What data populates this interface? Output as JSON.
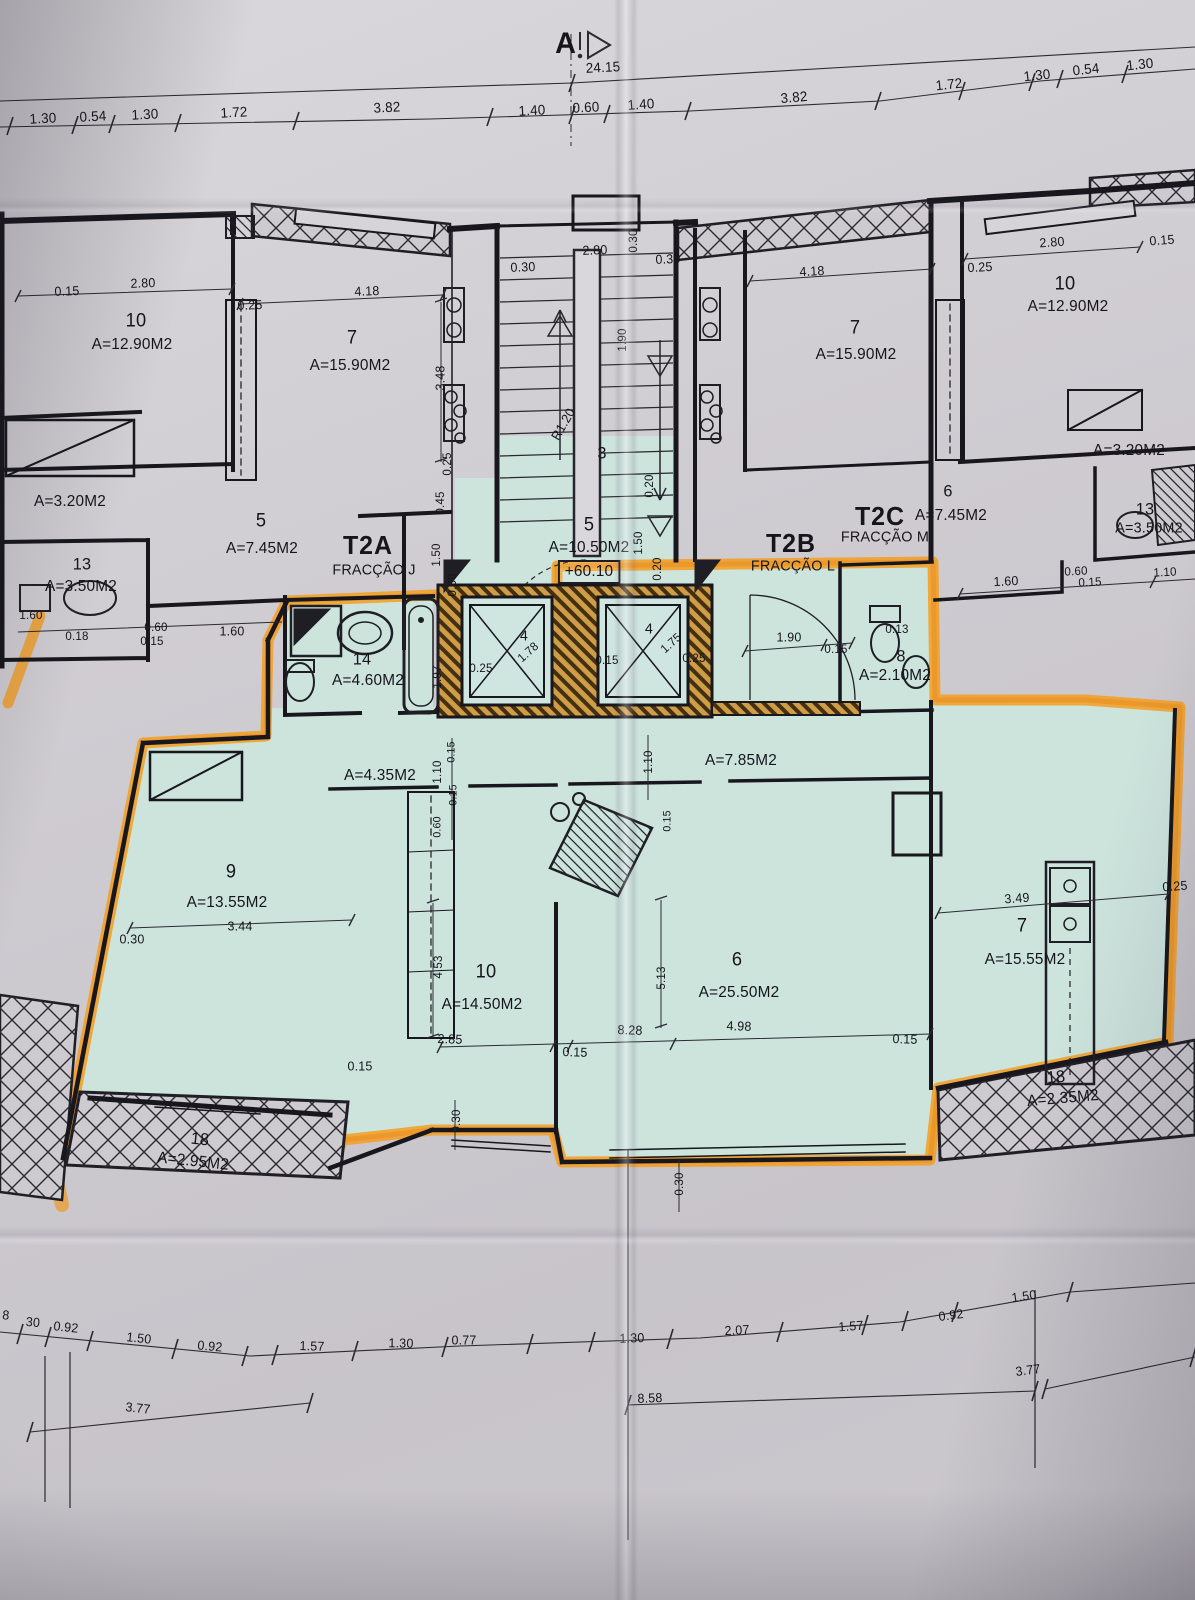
{
  "drawing": {
    "section_marker": "A",
    "overall_dimension": "24.15",
    "elevation_label": "+60.10",
    "fractions": [
      {
        "code": "T2A",
        "name": "FRACÇÃO J"
      },
      {
        "code": "T2B",
        "name": "FRACÇÃO L"
      },
      {
        "code": "T2C",
        "name": "FRACÇÃO M"
      }
    ],
    "colors": {
      "paper": "#cfccd2",
      "highlight_teal": "#cde4dd",
      "highlighter_orange": "#f49d20",
      "ink": "#1e1e24"
    }
  },
  "labels": [
    {
      "t": "A",
      "x": 566,
      "y": 44,
      "s": 30,
      "n": "section-marker-label",
      "b": 1
    },
    {
      "t": "24.15",
      "x": 603,
      "y": 67,
      "s": 14,
      "r": -3,
      "n": "dimension-label"
    },
    {
      "t": "1.30",
      "x": 43,
      "y": 118,
      "s": 14,
      "r": -3,
      "n": "dimension-label"
    },
    {
      "t": "0.54",
      "x": 93,
      "y": 116,
      "s": 14,
      "r": -3,
      "n": "dimension-label"
    },
    {
      "t": "1.30",
      "x": 145,
      "y": 114,
      "s": 14,
      "r": -3,
      "n": "dimension-label"
    },
    {
      "t": "1.72",
      "x": 234,
      "y": 112,
      "s": 14,
      "r": -3,
      "n": "dimension-label"
    },
    {
      "t": "3.82",
      "x": 387,
      "y": 107,
      "s": 14,
      "r": -3,
      "n": "dimension-label"
    },
    {
      "t": "1.40",
      "x": 532,
      "y": 110,
      "s": 14,
      "r": -3,
      "n": "dimension-label"
    },
    {
      "t": "0.60",
      "x": 586,
      "y": 107,
      "s": 14,
      "r": -3,
      "n": "dimension-label"
    },
    {
      "t": "1.40",
      "x": 641,
      "y": 104,
      "s": 14,
      "r": -4,
      "n": "dimension-label"
    },
    {
      "t": "3.82",
      "x": 794,
      "y": 97,
      "s": 14,
      "r": -5,
      "n": "dimension-label"
    },
    {
      "t": "1.72",
      "x": 949,
      "y": 84,
      "s": 14,
      "r": -6,
      "n": "dimension-label"
    },
    {
      "t": "1.30",
      "x": 1037,
      "y": 75,
      "s": 14,
      "r": -6,
      "n": "dimension-label"
    },
    {
      "t": "0.54",
      "x": 1086,
      "y": 69,
      "s": 14,
      "r": -6,
      "n": "dimension-label"
    },
    {
      "t": "1.30",
      "x": 1140,
      "y": 64,
      "s": 14,
      "r": -6,
      "n": "dimension-label"
    },
    {
      "t": "0.15",
      "x": 67,
      "y": 291,
      "s": 13,
      "r": -2,
      "n": "dimension-label"
    },
    {
      "t": "2.80",
      "x": 143,
      "y": 283,
      "s": 13,
      "r": -2,
      "n": "dimension-label"
    },
    {
      "t": "0.25",
      "x": 250,
      "y": 305,
      "s": 13,
      "r": -2,
      "n": "dimension-label"
    },
    {
      "t": "4.18",
      "x": 367,
      "y": 291,
      "s": 13,
      "r": -2,
      "n": "dimension-label"
    },
    {
      "t": "10",
      "x": 136,
      "y": 321,
      "s": 19,
      "n": "room-number-label"
    },
    {
      "t": "A=12.90M2",
      "x": 132,
      "y": 345,
      "s": 16,
      "n": "room-area-label"
    },
    {
      "t": "7",
      "x": 352,
      "y": 338,
      "s": 19,
      "n": "room-number-label"
    },
    {
      "t": "A=15.90M2",
      "x": 350,
      "y": 366,
      "s": 16,
      "n": "room-area-label"
    },
    {
      "t": "3.48",
      "x": 440,
      "y": 378,
      "s": 13,
      "r": -90,
      "n": "dimension-label"
    },
    {
      "t": "A=3.20M2",
      "x": 70,
      "y": 502,
      "s": 16,
      "n": "room-area-label"
    },
    {
      "t": "5",
      "x": 261,
      "y": 521,
      "s": 19,
      "n": "room-number-label"
    },
    {
      "t": "A=7.45M2",
      "x": 262,
      "y": 549,
      "s": 16,
      "n": "room-area-label"
    },
    {
      "t": "13",
      "x": 82,
      "y": 564,
      "s": 17,
      "n": "room-number-label"
    },
    {
      "t": "A=3.50M2",
      "x": 81,
      "y": 587,
      "s": 16,
      "n": "room-area-label"
    },
    {
      "t": "1.60",
      "x": 31,
      "y": 615,
      "s": 12,
      "n": "dimension-label"
    },
    {
      "t": "0.18",
      "x": 77,
      "y": 636,
      "s": 12,
      "n": "dimension-label"
    },
    {
      "t": "0.60",
      "x": 156,
      "y": 627,
      "s": 12,
      "n": "dimension-label"
    },
    {
      "t": "0.15",
      "x": 152,
      "y": 641,
      "s": 12,
      "n": "dimension-label"
    },
    {
      "t": "1.60",
      "x": 232,
      "y": 631,
      "s": 13,
      "n": "dimension-label"
    },
    {
      "t": "T2A",
      "x": 368,
      "y": 545,
      "s": 26,
      "b": 1,
      "n": "unit-code-label"
    },
    {
      "t": "FRACÇÃO J",
      "x": 374,
      "y": 570,
      "s": 15,
      "n": "fraction-name-label"
    },
    {
      "t": "0.25",
      "x": 447,
      "y": 464,
      "s": 12,
      "r": -90,
      "n": "dimension-label"
    },
    {
      "t": "0.45",
      "x": 440,
      "y": 503,
      "s": 12,
      "r": -90,
      "n": "dimension-label"
    },
    {
      "t": "1.50",
      "x": 436,
      "y": 555,
      "s": 12,
      "r": -90,
      "n": "dimension-label"
    },
    {
      "t": "0.30",
      "x": 452,
      "y": 585,
      "s": 12,
      "r": -90,
      "n": "dimension-label"
    },
    {
      "t": "2.80",
      "x": 595,
      "y": 250,
      "s": 13,
      "r": -2,
      "n": "dimension-label"
    },
    {
      "t": "0.30",
      "x": 633,
      "y": 241,
      "s": 12,
      "r": -90,
      "n": "dimension-label"
    },
    {
      "t": "0.30",
      "x": 523,
      "y": 267,
      "s": 13,
      "r": -2,
      "n": "dimension-label"
    },
    {
      "t": "0.30",
      "x": 668,
      "y": 259,
      "s": 13,
      "r": -2,
      "n": "dimension-label"
    },
    {
      "t": "1.90",
      "x": 622,
      "y": 340,
      "s": 12,
      "r": -90,
      "n": "dimension-label"
    },
    {
      "t": "R1.20",
      "x": 563,
      "y": 424,
      "s": 13,
      "r": -60,
      "n": "dimension-label"
    },
    {
      "t": "3",
      "x": 602,
      "y": 453,
      "s": 17,
      "n": "room-number-label"
    },
    {
      "t": "5",
      "x": 589,
      "y": 525,
      "s": 19,
      "n": "room-number-label"
    },
    {
      "t": "A=10.50M2",
      "x": 589,
      "y": 548,
      "s": 16,
      "n": "room-area-label"
    },
    {
      "t": "+60.10",
      "x": 589,
      "y": 572,
      "s": 16,
      "box": 1,
      "n": "elevation-label"
    },
    {
      "t": "0.20",
      "x": 649,
      "y": 486,
      "s": 12,
      "r": -90,
      "n": "dimension-label"
    },
    {
      "t": "1.50",
      "x": 638,
      "y": 543,
      "s": 12,
      "r": -90,
      "n": "dimension-label"
    },
    {
      "t": "0.20",
      "x": 657,
      "y": 569,
      "s": 12,
      "r": -90,
      "n": "dimension-label"
    },
    {
      "t": "2.80",
      "x": 1052,
      "y": 242,
      "s": 13,
      "r": -4,
      "n": "dimension-label"
    },
    {
      "t": "0.15",
      "x": 1162,
      "y": 240,
      "s": 13,
      "r": -4,
      "n": "dimension-label"
    },
    {
      "t": "0.25",
      "x": 980,
      "y": 267,
      "s": 13,
      "r": -3,
      "n": "dimension-label"
    },
    {
      "t": "4.18",
      "x": 812,
      "y": 271,
      "s": 13,
      "r": -3,
      "n": "dimension-label"
    },
    {
      "t": "10",
      "x": 1065,
      "y": 284,
      "s": 19,
      "n": "room-number-label"
    },
    {
      "t": "A=12.90M2",
      "x": 1068,
      "y": 307,
      "s": 16,
      "n": "room-area-label"
    },
    {
      "t": "7",
      "x": 855,
      "y": 328,
      "s": 19,
      "n": "room-number-label"
    },
    {
      "t": "A=15.90M2",
      "x": 856,
      "y": 355,
      "s": 16,
      "n": "room-area-label"
    },
    {
      "t": "A=3.20M2",
      "x": 1129,
      "y": 451,
      "s": 16,
      "n": "room-area-label"
    },
    {
      "t": "6",
      "x": 948,
      "y": 491,
      "s": 17,
      "n": "room-number-label"
    },
    {
      "t": "A=7.45M2",
      "x": 951,
      "y": 516,
      "s": 16,
      "n": "room-area-label"
    },
    {
      "t": "13",
      "x": 1145,
      "y": 509,
      "s": 17,
      "n": "room-number-label"
    },
    {
      "t": "A=3.50M2",
      "x": 1149,
      "y": 528,
      "s": 15,
      "n": "room-area-label"
    },
    {
      "t": "T2C",
      "x": 880,
      "y": 516,
      "s": 26,
      "b": 1,
      "n": "unit-code-label"
    },
    {
      "t": "FRACÇÃO M",
      "x": 885,
      "y": 537,
      "s": 15,
      "n": "fraction-name-label"
    },
    {
      "t": "T2B",
      "x": 791,
      "y": 543,
      "s": 26,
      "b": 1,
      "n": "unit-code-label"
    },
    {
      "t": "FRACÇÃO L",
      "x": 793,
      "y": 566,
      "s": 15,
      "n": "fraction-name-label"
    },
    {
      "t": "1.60",
      "x": 1006,
      "y": 581,
      "s": 13,
      "r": -3,
      "n": "dimension-label"
    },
    {
      "t": "0.60",
      "x": 1076,
      "y": 571,
      "s": 12,
      "r": -3,
      "n": "dimension-label"
    },
    {
      "t": "0.15",
      "x": 1090,
      "y": 582,
      "s": 12,
      "r": -3,
      "n": "dimension-label"
    },
    {
      "t": "1.10",
      "x": 1165,
      "y": 572,
      "s": 12,
      "r": -3,
      "n": "dimension-label"
    },
    {
      "t": "14",
      "x": 362,
      "y": 659,
      "s": 17,
      "n": "room-number-label"
    },
    {
      "t": "A=4.60M2",
      "x": 368,
      "y": 681,
      "s": 16,
      "n": "room-area-label"
    },
    {
      "t": "1.97",
      "x": 437,
      "y": 677,
      "s": 12,
      "r": -90,
      "n": "dimension-label"
    },
    {
      "t": "0.25",
      "x": 481,
      "y": 668,
      "s": 12,
      "n": "dimension-label"
    },
    {
      "t": "4",
      "x": 524,
      "y": 636,
      "s": 15,
      "n": "room-number-label"
    },
    {
      "t": "1.78",
      "x": 528,
      "y": 652,
      "s": 12,
      "r": -42,
      "n": "dimension-label"
    },
    {
      "t": "4",
      "x": 649,
      "y": 629,
      "s": 15,
      "n": "room-number-label"
    },
    {
      "t": "1.75",
      "x": 671,
      "y": 643,
      "s": 12,
      "r": -42,
      "n": "dimension-label"
    },
    {
      "t": "0.15",
      "x": 607,
      "y": 660,
      "s": 12,
      "n": "dimension-label"
    },
    {
      "t": "0.25",
      "x": 694,
      "y": 658,
      "s": 12,
      "n": "dimension-label"
    },
    {
      "t": "1.90",
      "x": 789,
      "y": 637,
      "s": 13,
      "n": "dimension-label"
    },
    {
      "t": "0.15",
      "x": 836,
      "y": 649,
      "s": 12,
      "n": "dimension-label"
    },
    {
      "t": "0.13",
      "x": 897,
      "y": 629,
      "s": 12,
      "n": "dimension-label"
    },
    {
      "t": "8",
      "x": 901,
      "y": 656,
      "s": 17,
      "n": "room-number-label"
    },
    {
      "t": "A=2.10M2",
      "x": 895,
      "y": 676,
      "s": 16,
      "n": "room-area-label"
    },
    {
      "t": "A=4.35M2",
      "x": 380,
      "y": 776,
      "s": 16,
      "n": "room-area-label"
    },
    {
      "t": "1.10",
      "x": 437,
      "y": 772,
      "s": 12,
      "r": -90,
      "n": "dimension-label"
    },
    {
      "t": "0.15",
      "x": 452,
      "y": 752,
      "s": 11,
      "r": -90,
      "n": "dimension-label"
    },
    {
      "t": "0.15",
      "x": 454,
      "y": 795,
      "s": 11,
      "r": -90,
      "n": "dimension-label"
    },
    {
      "t": "0.60",
      "x": 438,
      "y": 827,
      "s": 11,
      "r": -90,
      "n": "dimension-label"
    },
    {
      "t": "1.10",
      "x": 648,
      "y": 762,
      "s": 12,
      "r": -90,
      "n": "dimension-label"
    },
    {
      "t": "A=7.85M2",
      "x": 741,
      "y": 761,
      "s": 16,
      "n": "room-area-label"
    },
    {
      "t": "0.15",
      "x": 668,
      "y": 821,
      "s": 11,
      "r": -90,
      "n": "dimension-label"
    },
    {
      "t": "9",
      "x": 231,
      "y": 872,
      "s": 19,
      "n": "room-number-label"
    },
    {
      "t": "A=13.55M2",
      "x": 227,
      "y": 903,
      "s": 16,
      "n": "room-area-label"
    },
    {
      "t": "3.44",
      "x": 240,
      "y": 926,
      "s": 13,
      "n": "dimension-label"
    },
    {
      "t": "0.30",
      "x": 132,
      "y": 939,
      "s": 13,
      "n": "dimension-label"
    },
    {
      "t": "4.53",
      "x": 438,
      "y": 967,
      "s": 12,
      "r": -90,
      "n": "dimension-label"
    },
    {
      "t": "10",
      "x": 486,
      "y": 972,
      "s": 19,
      "n": "room-number-label"
    },
    {
      "t": "A=14.50M2",
      "x": 482,
      "y": 1005,
      "s": 16,
      "n": "room-area-label"
    },
    {
      "t": "2.85",
      "x": 450,
      "y": 1039,
      "s": 13,
      "r": 2,
      "n": "dimension-label"
    },
    {
      "t": "0.15",
      "x": 575,
      "y": 1052,
      "s": 13,
      "r": 2,
      "n": "dimension-label"
    },
    {
      "t": "5.13",
      "x": 661,
      "y": 978,
      "s": 12,
      "r": -90,
      "n": "dimension-label"
    },
    {
      "t": "6",
      "x": 737,
      "y": 960,
      "s": 19,
      "n": "room-number-label"
    },
    {
      "t": "A=25.50M2",
      "x": 739,
      "y": 993,
      "s": 16,
      "n": "room-area-label"
    },
    {
      "t": "8.28",
      "x": 630,
      "y": 1030,
      "s": 13,
      "r": 2,
      "n": "dimension-label"
    },
    {
      "t": "4.98",
      "x": 739,
      "y": 1026,
      "s": 13,
      "r": 2,
      "n": "dimension-label"
    },
    {
      "t": "0.15",
      "x": 905,
      "y": 1039,
      "s": 13,
      "r": 2,
      "n": "dimension-label"
    },
    {
      "t": "3.49",
      "x": 1017,
      "y": 898,
      "s": 13,
      "r": -4,
      "n": "dimension-label"
    },
    {
      "t": "7",
      "x": 1022,
      "y": 926,
      "s": 19,
      "n": "room-number-label"
    },
    {
      "t": "A=15.55M2",
      "x": 1025,
      "y": 960,
      "s": 16,
      "n": "room-area-label"
    },
    {
      "t": "0.25",
      "x": 1175,
      "y": 886,
      "s": 13,
      "r": -4,
      "n": "dimension-label"
    },
    {
      "t": "0.15",
      "x": 360,
      "y": 1066,
      "s": 13,
      "n": "dimension-label"
    },
    {
      "t": "18",
      "x": 200,
      "y": 1139,
      "s": 17,
      "r": 6,
      "n": "room-number-label"
    },
    {
      "t": "A=2.95M2",
      "x": 193,
      "y": 1162,
      "s": 16,
      "r": 6,
      "n": "room-area-label"
    },
    {
      "t": "18",
      "x": 1056,
      "y": 1077,
      "s": 17,
      "r": -5,
      "n": "room-number-label"
    },
    {
      "t": "A=2.35M2",
      "x": 1063,
      "y": 1099,
      "s": 16,
      "r": -5,
      "n": "room-area-label"
    },
    {
      "t": "0.30",
      "x": 456,
      "y": 1121,
      "s": 12,
      "r": -90,
      "n": "dimension-label"
    },
    {
      "t": "0.30",
      "x": 679,
      "y": 1184,
      "s": 12,
      "r": -90,
      "n": "dimension-label"
    },
    {
      "t": "8",
      "x": 6,
      "y": 1315,
      "s": 13,
      "r": 5,
      "n": "dimension-label"
    },
    {
      "t": "30",
      "x": 33,
      "y": 1322,
      "s": 13,
      "r": 5,
      "n": "dimension-label"
    },
    {
      "t": "0.92",
      "x": 66,
      "y": 1327,
      "s": 13,
      "r": 6,
      "n": "dimension-label"
    },
    {
      "t": "1.50",
      "x": 139,
      "y": 1338,
      "s": 13,
      "r": 6,
      "n": "dimension-label"
    },
    {
      "t": "0.92",
      "x": 210,
      "y": 1346,
      "s": 13,
      "r": 5,
      "n": "dimension-label"
    },
    {
      "t": "1.57",
      "x": 312,
      "y": 1346,
      "s": 13,
      "r": 2,
      "n": "dimension-label"
    },
    {
      "t": "1.30",
      "x": 401,
      "y": 1343,
      "s": 13,
      "r": 1,
      "n": "dimension-label"
    },
    {
      "t": "0.77",
      "x": 464,
      "y": 1340,
      "s": 13,
      "n": "dimension-label"
    },
    {
      "t": "1.30",
      "x": 632,
      "y": 1338,
      "s": 13,
      "r": -2,
      "n": "dimension-label"
    },
    {
      "t": "2.07",
      "x": 737,
      "y": 1330,
      "s": 13,
      "r": -3,
      "n": "dimension-label"
    },
    {
      "t": "1.57",
      "x": 851,
      "y": 1326,
      "s": 13,
      "r": -4,
      "n": "dimension-label"
    },
    {
      "t": "0.92",
      "x": 951,
      "y": 1315,
      "s": 13,
      "r": -7,
      "n": "dimension-label"
    },
    {
      "t": "1.50",
      "x": 1024,
      "y": 1296,
      "s": 13,
      "r": -8,
      "n": "dimension-label"
    },
    {
      "t": "3.77",
      "x": 138,
      "y": 1408,
      "s": 13,
      "r": 6,
      "n": "dimension-label"
    },
    {
      "t": "8.58",
      "x": 650,
      "y": 1398,
      "s": 13,
      "r": -2,
      "n": "dimension-label"
    },
    {
      "t": "3.77",
      "x": 1028,
      "y": 1370,
      "s": 13,
      "r": -7,
      "n": "dimension-label"
    }
  ]
}
